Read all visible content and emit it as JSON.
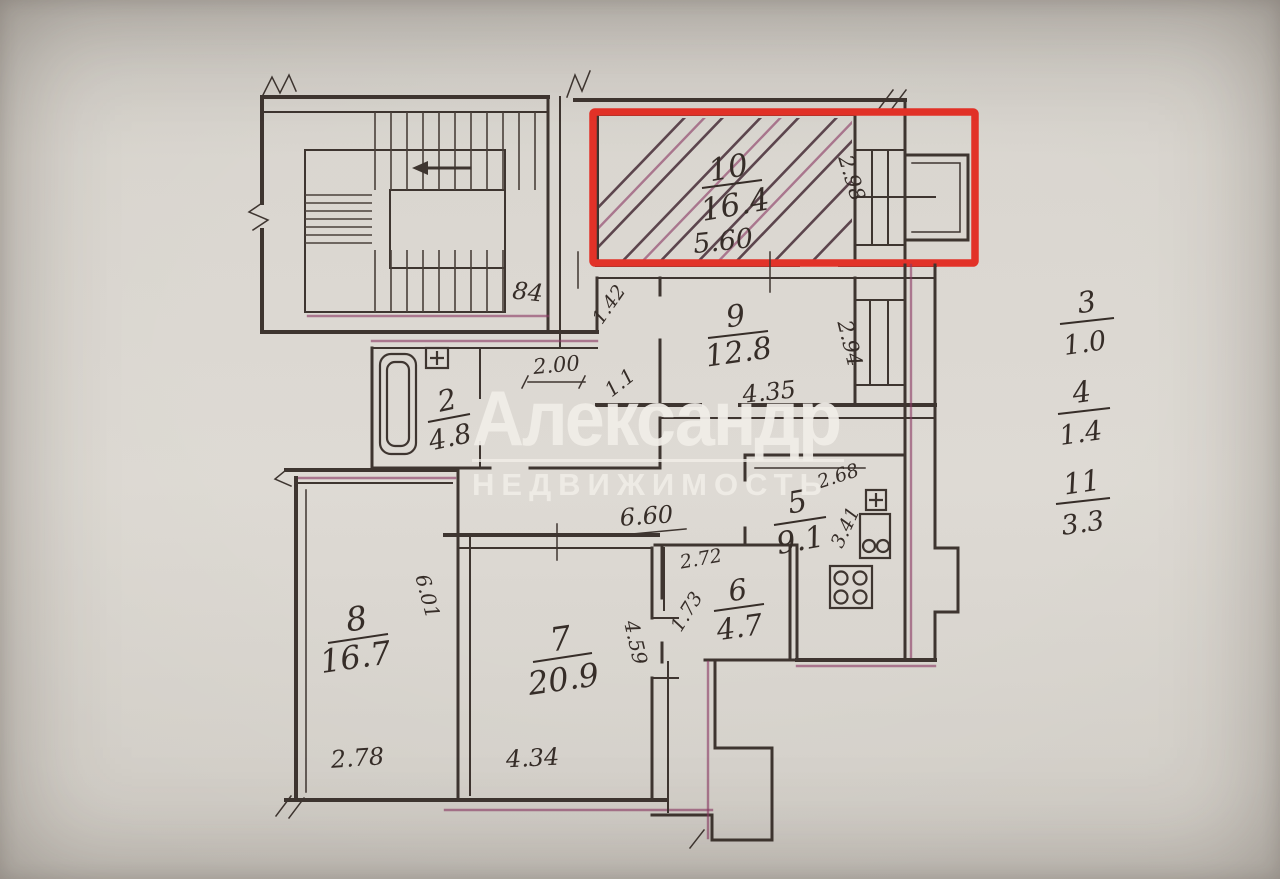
{
  "plan": {
    "stair_label": "84",
    "corridor": {
      "dim_long": "6.60",
      "dim_hall": "2.00",
      "dim_small": "1.1",
      "dim_diag": "1.42"
    },
    "rooms": {
      "r2": {
        "number": "2",
        "area": "4.8"
      },
      "r5": {
        "number": "5",
        "area": "9.1",
        "dim_a": "2.68",
        "dim_b": "3.41"
      },
      "r6": {
        "number": "6",
        "area": "4.7",
        "dim_a": "2.72",
        "dim_b": "1.73"
      },
      "r7": {
        "number": "7",
        "area": "20.9",
        "dim_w": "4.34",
        "dim_h": "4.59"
      },
      "r8": {
        "number": "8",
        "area": "16.7",
        "dim_w": "2.78",
        "dim_h": "6.01"
      },
      "r9": {
        "number": "9",
        "area": "12.8",
        "dim_w": "4.35",
        "dim_h": "2.94"
      },
      "r10": {
        "number": "10",
        "area": "16.4",
        "dim_w": "5.60",
        "dim_h": "2.98",
        "highlighted": true
      }
    },
    "margin_notes": [
      {
        "number": "3",
        "area": "1.0"
      },
      {
        "number": "4",
        "area": "1.4"
      },
      {
        "number": "11",
        "area": "3.3"
      }
    ],
    "highlight_color": "#e23228"
  },
  "watermark": {
    "title": "Александр",
    "subtitle": "НЕДВИЖИМОСТЬ"
  }
}
